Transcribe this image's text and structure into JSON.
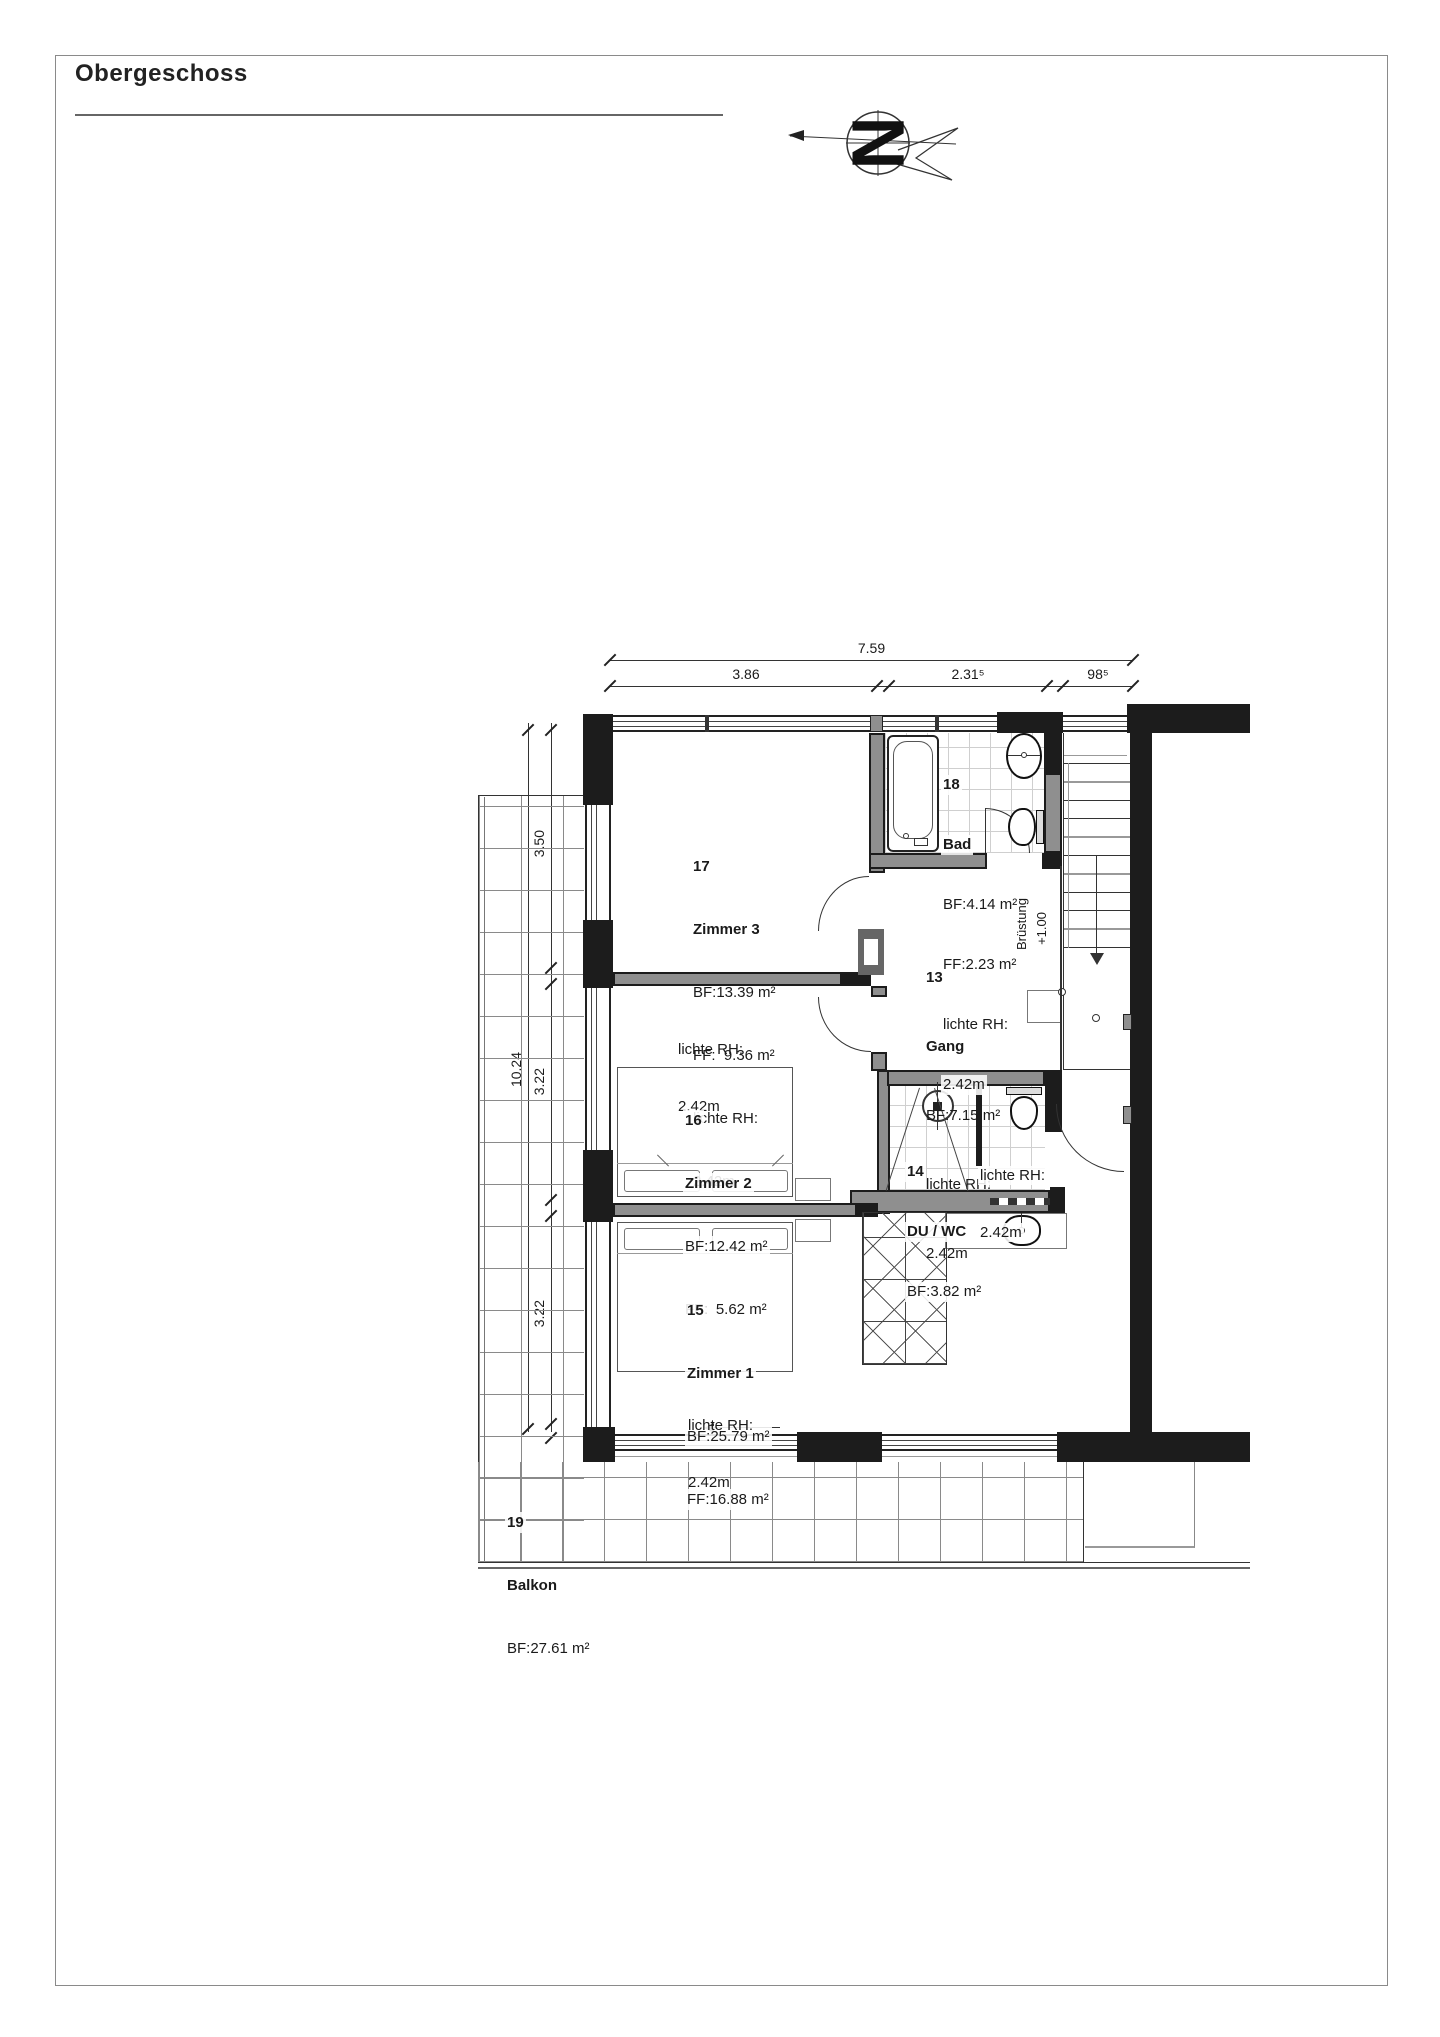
{
  "page": {
    "title": "Obergeschoss"
  },
  "north": {
    "letter": "N"
  },
  "dims": {
    "top_total": "7.59",
    "top_segs": [
      "3.86",
      "2.31⁵",
      "98⁵"
    ],
    "left_total": "10.24",
    "left_segs": [
      "3.50",
      "3.22",
      "3.22"
    ]
  },
  "labels": {
    "bruestung_line1": "Brüstung",
    "bruestung_line2": "+1.00"
  },
  "rooms": {
    "z3": {
      "id": "17",
      "name": "Zimmer 3",
      "bf": "BF:13.39 m²",
      "ff": "FF:  9.36 m²",
      "rh1": "lichte RH:",
      "rh2": "2.42m"
    },
    "z2": {
      "id": "16",
      "name": "Zimmer 2",
      "bf": "BF:12.42 m²",
      "ff": "FF:  5.62 m²",
      "rh1": "lichte RH:",
      "rh2": "2.42m"
    },
    "z1": {
      "id": "15",
      "name": "Zimmer 1",
      "bf": "BF:25.79 m²",
      "ff": "FF:16.88 m²",
      "rh1": "lichte RH:",
      "rh2": "2.42m"
    },
    "bad": {
      "id": "18",
      "name": "Bad",
      "bf": "BF:4.14 m²",
      "ff": "FF:2.23 m²",
      "rh1": "lichte RH:",
      "rh2": "2.42m"
    },
    "gang": {
      "id": "13",
      "name": "Gang",
      "bf": "BF:7.15 m²",
      "rh1": "lichte RH:",
      "rh2": "2.42m"
    },
    "duwc": {
      "id": "14",
      "name": "DU / WC",
      "bf": "BF:3.82 m²",
      "rh1": "lichte RH:",
      "rh2": "2.42m"
    },
    "balkon": {
      "id": "19",
      "name": "Balkon",
      "bf": "BF:27.61 m²"
    }
  }
}
